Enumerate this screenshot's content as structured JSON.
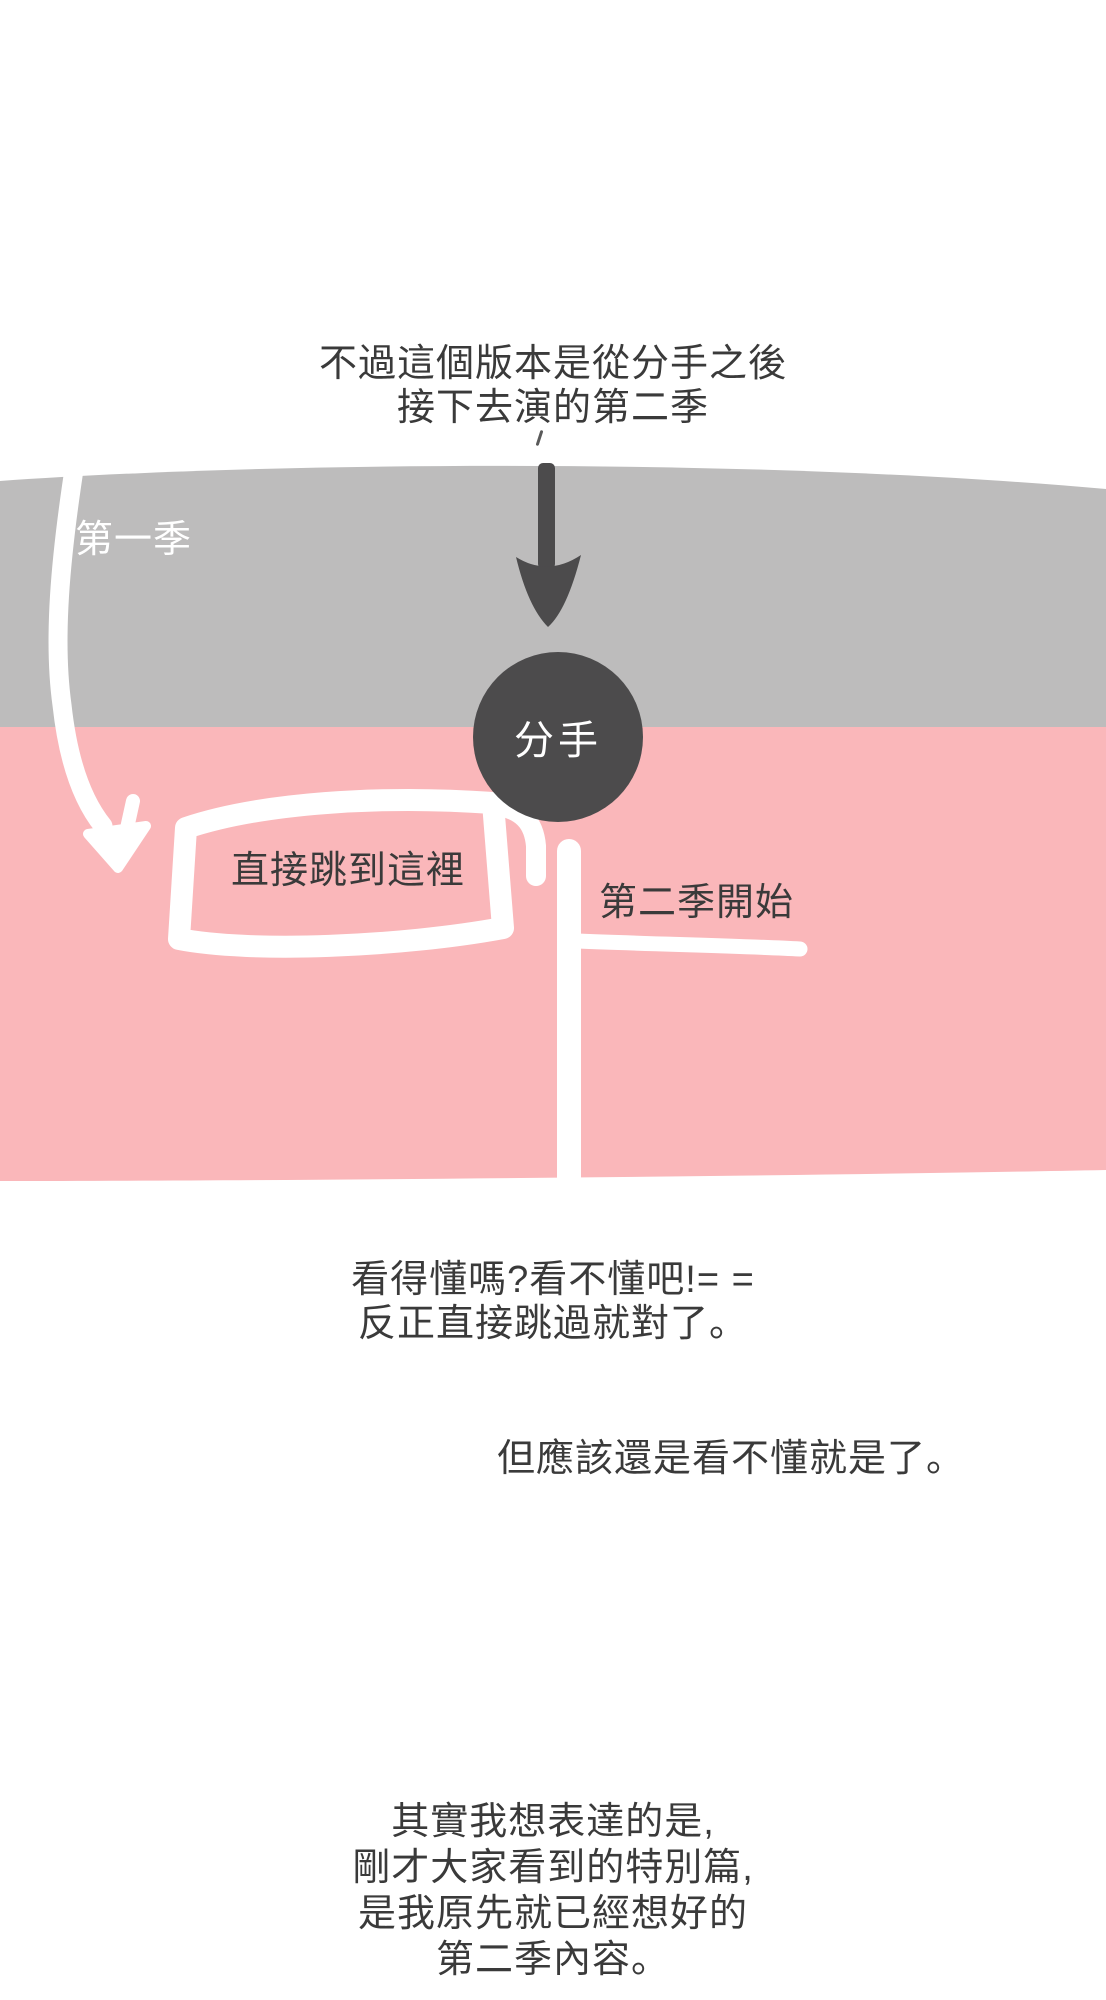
{
  "colors": {
    "gray_band": "#bdbcbc",
    "pink_band": "#fab7ba",
    "ink_dark": "#4c4b4c",
    "text_dark": "#3a3a3a",
    "stroke_white": "#ffffff",
    "page_bg": "#ffffff"
  },
  "intro": {
    "line1": "不過這個版本是從分手之後",
    "line2": "接下去演的第二季"
  },
  "banner": {
    "season1_label": "第一季",
    "breakup_label": "分手",
    "jump_box_label": "直接跳到這裡",
    "season2_label": "第二季開始"
  },
  "mid": {
    "line1": "看得懂嗎?看不懂吧!= =",
    "line2": "反正直接跳過就對了。",
    "line3": "但應該還是看不懂就是了。"
  },
  "footer": {
    "line1": "其實我想表達的是,",
    "line2": "剛才大家看到的特別篇,",
    "line3": "是我原先就已經想好的",
    "line4": "第二季內容。"
  }
}
